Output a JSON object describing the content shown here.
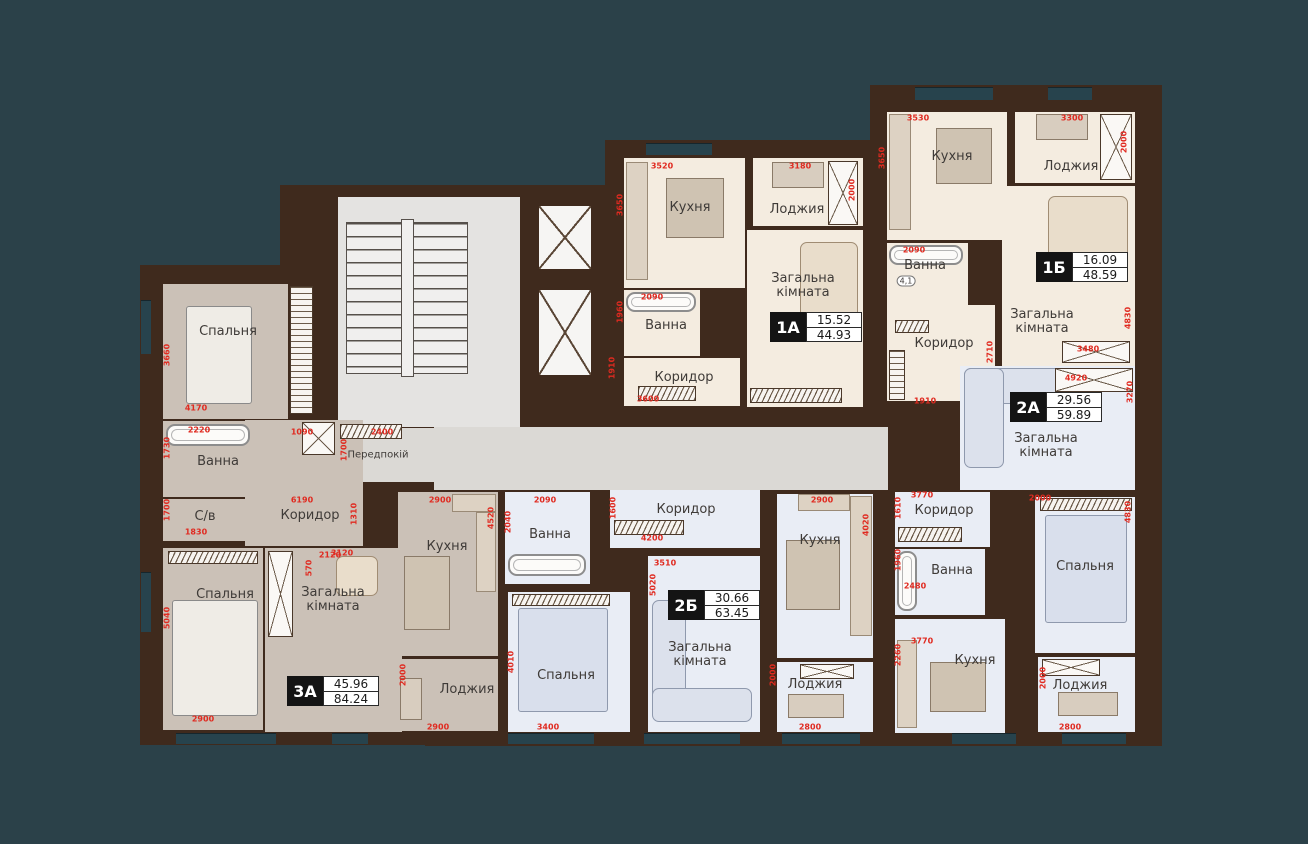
{
  "title": "Floor plan with apartments 1А, 1Б, 2А, 2Б, 3А",
  "colors": {
    "background": "#2b4149",
    "wall": "#3f2a1d",
    "dim_red": "#e02a20",
    "floor_cream": "#f4ece0",
    "floor_blue": "#e9edf5",
    "floor_gray": "#cbc1b7",
    "corridor": "#dbd9d5",
    "badge_black": "#141414"
  },
  "units": [
    {
      "id": "1А",
      "living_area": "15.52",
      "total_area": "44.93"
    },
    {
      "id": "1Б",
      "living_area": "16.09",
      "total_area": "48.59"
    },
    {
      "id": "2А",
      "living_area": "29.56",
      "total_area": "59.89"
    },
    {
      "id": "2Б",
      "living_area": "30.66",
      "total_area": "63.45"
    },
    {
      "id": "3А",
      "living_area": "45.96",
      "total_area": "84.24"
    }
  ],
  "walls": [
    {
      "x": 140,
      "y": 265,
      "w": 200,
      "h": 480
    },
    {
      "x": 280,
      "y": 185,
      "w": 350,
      "h": 560
    },
    {
      "x": 605,
      "y": 140,
      "w": 270,
      "h": 290
    },
    {
      "x": 870,
      "y": 85,
      "w": 292,
      "h": 335
    },
    {
      "x": 870,
      "y": 358,
      "w": 292,
      "h": 388
    },
    {
      "x": 425,
      "y": 420,
      "w": 470,
      "h": 326
    }
  ],
  "floors": [
    {
      "apt": "core",
      "room": "stair-hall",
      "color": "stair",
      "x": 338,
      "y": 197,
      "w": 182,
      "h": 230
    },
    {
      "apt": "core",
      "room": "elevator-1",
      "color": "white",
      "x": 537,
      "y": 204,
      "w": 56,
      "h": 67
    },
    {
      "apt": "core",
      "room": "elevator-2",
      "color": "white",
      "x": 537,
      "y": 288,
      "w": 56,
      "h": 89
    },
    {
      "apt": "core",
      "room": "corridor-common",
      "color": "corr",
      "x": 434,
      "y": 427,
      "w": 454,
      "h": 63
    },
    {
      "apt": "core",
      "room": "entry-hall",
      "label": "Передпокій",
      "lx": 378,
      "ly": 456,
      "small": true,
      "color": "corr",
      "x": 318,
      "y": 428,
      "w": 116,
      "h": 54
    },
    {
      "apt": "3А",
      "room": "bedroom-1",
      "label": "Спальня",
      "lx": 228,
      "ly": 332,
      "color": "gray3",
      "x": 163,
      "y": 284,
      "w": 125,
      "h": 135
    },
    {
      "apt": "3А",
      "room": "bath",
      "label": "Ванна",
      "lx": 218,
      "ly": 462,
      "color": "gray3",
      "x": 163,
      "y": 421,
      "w": 110,
      "h": 76
    },
    {
      "apt": "3А",
      "room": "wc",
      "label": "С/в",
      "lx": 205,
      "ly": 517,
      "color": "gray3",
      "x": 163,
      "y": 499,
      "w": 103,
      "h": 42
    },
    {
      "apt": "3А",
      "room": "corridor",
      "label": "Коридор",
      "lx": 310,
      "ly": 516,
      "color": "gray3",
      "x": 245,
      "y": 420,
      "w": 118,
      "h": 126
    },
    {
      "apt": "3А",
      "room": "bedroom-2",
      "label": "Спальня",
      "lx": 225,
      "ly": 595,
      "color": "gray3",
      "x": 163,
      "y": 548,
      "w": 100,
      "h": 182
    },
    {
      "apt": "3А",
      "room": "living",
      "label": "Загальна кімната",
      "wrap": true,
      "lx": 333,
      "ly": 600,
      "color": "gray3",
      "x": 265,
      "y": 548,
      "w": 137,
      "h": 184
    },
    {
      "apt": "3А",
      "room": "kitchen",
      "label": "Кухня",
      "lx": 447,
      "ly": 547,
      "color": "gray3",
      "x": 398,
      "y": 492,
      "w": 100,
      "h": 164
    },
    {
      "apt": "3А",
      "room": "loggia",
      "label": "Лоджия",
      "lx": 467,
      "ly": 690,
      "color": "gray3",
      "x": 398,
      "y": 659,
      "w": 100,
      "h": 72
    },
    {
      "apt": "1А",
      "room": "kitchen",
      "label": "Кухня",
      "lx": 690,
      "ly": 208,
      "color": "cream",
      "x": 624,
      "y": 158,
      "w": 121,
      "h": 130
    },
    {
      "apt": "1А",
      "room": "loggia",
      "label": "Лоджия",
      "lx": 797,
      "ly": 210,
      "color": "cream",
      "x": 753,
      "y": 158,
      "w": 110,
      "h": 68
    },
    {
      "apt": "1А",
      "room": "living",
      "label": "Загальна кімната",
      "wrap": true,
      "lx": 803,
      "ly": 286,
      "color": "cream",
      "x": 747,
      "y": 230,
      "w": 116,
      "h": 177
    },
    {
      "apt": "1А",
      "room": "bath",
      "label": "Ванна",
      "lx": 666,
      "ly": 326,
      "color": "cream",
      "x": 624,
      "y": 290,
      "w": 76,
      "h": 66
    },
    {
      "apt": "1А",
      "room": "corridor",
      "label": "Коридор",
      "lx": 684,
      "ly": 378,
      "color": "cream",
      "x": 624,
      "y": 358,
      "w": 116,
      "h": 48
    },
    {
      "apt": "1Б",
      "room": "kitchen",
      "label": "Кухня",
      "lx": 952,
      "ly": 157,
      "color": "cream",
      "x": 887,
      "y": 112,
      "w": 120,
      "h": 128
    },
    {
      "apt": "1Б",
      "room": "loggia",
      "label": "Лоджия",
      "lx": 1071,
      "ly": 167,
      "color": "cream",
      "x": 1015,
      "y": 112,
      "w": 120,
      "h": 71
    },
    {
      "apt": "1Б",
      "room": "living",
      "label": "Загальна кімната",
      "wrap": true,
      "lx": 1042,
      "ly": 322,
      "color": "cream",
      "x": 1002,
      "y": 186,
      "w": 133,
      "h": 183
    },
    {
      "apt": "1Б",
      "room": "bath",
      "label": "Ванна",
      "lx": 925,
      "ly": 266,
      "color": "cream",
      "x": 887,
      "y": 243,
      "w": 81,
      "h": 62
    },
    {
      "apt": "1Б",
      "room": "corridor",
      "label": "Коридор",
      "lx": 944,
      "ly": 344,
      "color": "cream",
      "x": 887,
      "y": 305,
      "w": 108,
      "h": 96
    },
    {
      "apt": "2А",
      "room": "living",
      "label": "Загальна кімната",
      "wrap": true,
      "lx": 1046,
      "ly": 446,
      "color": "blue",
      "x": 960,
      "y": 366,
      "w": 175,
      "h": 124
    },
    {
      "apt": "2А",
      "room": "corridor",
      "label": "Коридор",
      "lx": 944,
      "ly": 511,
      "color": "blue",
      "x": 895,
      "y": 492,
      "w": 95,
      "h": 55
    },
    {
      "apt": "2А",
      "room": "bath",
      "label": "Ванна",
      "lx": 952,
      "ly": 571,
      "color": "blue",
      "x": 895,
      "y": 549,
      "w": 90,
      "h": 66
    },
    {
      "apt": "2А",
      "room": "kitchen",
      "label": "Кухня",
      "lx": 975,
      "ly": 661,
      "color": "blue",
      "x": 895,
      "y": 619,
      "w": 110,
      "h": 114
    },
    {
      "apt": "2А",
      "room": "bedroom",
      "label": "Спальня",
      "lx": 1085,
      "ly": 567,
      "color": "blue",
      "x": 1035,
      "y": 497,
      "w": 100,
      "h": 156
    },
    {
      "apt": "2А",
      "room": "loggia",
      "label": "Лоджия",
      "lx": 1080,
      "ly": 686,
      "color": "blue",
      "x": 1038,
      "y": 657,
      "w": 97,
      "h": 75
    },
    {
      "apt": "2Б",
      "room": "corridor",
      "label": "Коридор",
      "lx": 686,
      "ly": 510,
      "color": "blue",
      "x": 610,
      "y": 490,
      "w": 150,
      "h": 58
    },
    {
      "apt": "2Б",
      "room": "bath",
      "label": "Ванна",
      "lx": 550,
      "ly": 535,
      "color": "blue",
      "x": 505,
      "y": 492,
      "w": 85,
      "h": 92
    },
    {
      "apt": "2Б",
      "room": "bedroom",
      "label": "Спальня",
      "lx": 566,
      "ly": 676,
      "color": "blue",
      "x": 508,
      "y": 592,
      "w": 122,
      "h": 140
    },
    {
      "apt": "2Б",
      "room": "living",
      "label": "Загальна кімната",
      "wrap": true,
      "lx": 700,
      "ly": 655,
      "color": "blue",
      "x": 648,
      "y": 556,
      "w": 112,
      "h": 176
    },
    {
      "apt": "2Б",
      "room": "kitchen",
      "label": "Кухня",
      "lx": 820,
      "ly": 541,
      "color": "blue",
      "x": 777,
      "y": 494,
      "w": 96,
      "h": 164
    },
    {
      "apt": "2Б",
      "room": "loggia",
      "label": "Лоджия",
      "lx": 815,
      "ly": 685,
      "color": "blue",
      "x": 777,
      "y": 662,
      "w": 96,
      "h": 70
    }
  ],
  "badges": [
    {
      "unit": "1А",
      "top": "15.52",
      "bottom": "44.93",
      "x": 770,
      "y": 312
    },
    {
      "unit": "1Б",
      "top": "16.09",
      "bottom": "48.59",
      "x": 1036,
      "y": 252
    },
    {
      "unit": "2А",
      "top": "29.56",
      "bottom": "59.89",
      "x": 1010,
      "y": 392
    },
    {
      "unit": "2Б",
      "top": "30.66",
      "bottom": "63.45",
      "x": 668,
      "y": 590
    },
    {
      "unit": "3А",
      "top": "45.96",
      "bottom": "84.24",
      "x": 287,
      "y": 676
    }
  ],
  "dims": [
    {
      "t": "3520",
      "x": 662,
      "y": 166
    },
    {
      "t": "3650",
      "x": 620,
      "y": 205,
      "v": true
    },
    {
      "t": "3180",
      "x": 800,
      "y": 166
    },
    {
      "t": "2000",
      "x": 852,
      "y": 190,
      "v": true
    },
    {
      "t": "2090",
      "x": 652,
      "y": 297
    },
    {
      "t": "1960",
      "x": 620,
      "y": 312,
      "v": true
    },
    {
      "t": "1910",
      "x": 612,
      "y": 368,
      "v": true
    },
    {
      "t": "3600",
      "x": 648,
      "y": 399
    },
    {
      "t": "3530",
      "x": 918,
      "y": 118
    },
    {
      "t": "3650",
      "x": 882,
      "y": 158,
      "v": true
    },
    {
      "t": "3300",
      "x": 1072,
      "y": 118
    },
    {
      "t": "2000",
      "x": 1124,
      "y": 142,
      "v": true
    },
    {
      "t": "2090",
      "x": 914,
      "y": 250
    },
    {
      "t": "1910",
      "x": 925,
      "y": 401
    },
    {
      "t": "2710",
      "x": 990,
      "y": 352,
      "v": true
    },
    {
      "t": "4830",
      "x": 1128,
      "y": 318,
      "v": true
    },
    {
      "t": "3480",
      "x": 1088,
      "y": 349
    },
    {
      "t": "4920",
      "x": 1076,
      "y": 378
    },
    {
      "t": "3270",
      "x": 1130,
      "y": 392,
      "v": true
    },
    {
      "t": "2000",
      "x": 1040,
      "y": 498
    },
    {
      "t": "4830",
      "x": 1128,
      "y": 512,
      "v": true
    },
    {
      "t": "3770",
      "x": 922,
      "y": 495
    },
    {
      "t": "1610",
      "x": 898,
      "y": 508,
      "v": true
    },
    {
      "t": "2480",
      "x": 915,
      "y": 586
    },
    {
      "t": "1960",
      "x": 898,
      "y": 560,
      "v": true
    },
    {
      "t": "3770",
      "x": 922,
      "y": 641
    },
    {
      "t": "2260",
      "x": 898,
      "y": 655,
      "v": true
    },
    {
      "t": "2000",
      "x": 1043,
      "y": 678,
      "v": true
    },
    {
      "t": "2800",
      "x": 1070,
      "y": 727
    },
    {
      "t": "1600",
      "x": 613,
      "y": 508,
      "v": true
    },
    {
      "t": "4200",
      "x": 652,
      "y": 538
    },
    {
      "t": "3510",
      "x": 665,
      "y": 563
    },
    {
      "t": "5020",
      "x": 653,
      "y": 585,
      "v": true
    },
    {
      "t": "2900",
      "x": 822,
      "y": 500
    },
    {
      "t": "4020",
      "x": 866,
      "y": 525,
      "v": true
    },
    {
      "t": "2090",
      "x": 545,
      "y": 500
    },
    {
      "t": "2040",
      "x": 508,
      "y": 522,
      "v": true
    },
    {
      "t": "4010",
      "x": 511,
      "y": 662,
      "v": true
    },
    {
      "t": "3400",
      "x": 548,
      "y": 727
    },
    {
      "t": "2000",
      "x": 773,
      "y": 675,
      "v": true
    },
    {
      "t": "2800",
      "x": 810,
      "y": 727
    },
    {
      "t": "3660",
      "x": 167,
      "y": 355,
      "v": true
    },
    {
      "t": "4170",
      "x": 196,
      "y": 408
    },
    {
      "t": "2220",
      "x": 199,
      "y": 430
    },
    {
      "t": "1730",
      "x": 167,
      "y": 448,
      "v": true
    },
    {
      "t": "1830",
      "x": 196,
      "y": 532
    },
    {
      "t": "1700",
      "x": 167,
      "y": 510,
      "v": true
    },
    {
      "t": "1090",
      "x": 302,
      "y": 432
    },
    {
      "t": "1700",
      "x": 344,
      "y": 450,
      "v": true
    },
    {
      "t": "2400",
      "x": 382,
      "y": 432
    },
    {
      "t": "6190",
      "x": 302,
      "y": 500
    },
    {
      "t": "1310",
      "x": 354,
      "y": 514,
      "v": true
    },
    {
      "t": "2120",
      "x": 330,
      "y": 555
    },
    {
      "t": "5040",
      "x": 167,
      "y": 618,
      "v": true
    },
    {
      "t": "2900",
      "x": 203,
      "y": 719
    },
    {
      "t": "3120",
      "x": 342,
      "y": 553
    },
    {
      "t": "570",
      "x": 309,
      "y": 568,
      "v": true
    },
    {
      "t": "2900",
      "x": 440,
      "y": 500
    },
    {
      "t": "4520",
      "x": 491,
      "y": 518,
      "v": true
    },
    {
      "t": "2000",
      "x": 403,
      "y": 675,
      "v": true
    },
    {
      "t": "2900",
      "x": 438,
      "y": 727
    }
  ],
  "notes": [
    {
      "t": "4,1",
      "x": 906,
      "y": 281
    }
  ],
  "fixtures": [
    {
      "type": "stairs",
      "x": 346,
      "y": 222,
      "w": 122,
      "h": 152
    },
    {
      "type": "elev",
      "x": 537,
      "y": 204,
      "w": 56,
      "h": 67
    },
    {
      "type": "elev",
      "x": 537,
      "y": 288,
      "w": 56,
      "h": 89
    },
    {
      "type": "xbox",
      "x": 302,
      "y": 422,
      "w": 33,
      "h": 33
    },
    {
      "type": "hatch",
      "x": 340,
      "y": 424,
      "w": 62,
      "h": 15
    },
    {
      "type": "hatchv",
      "x": 290,
      "y": 286,
      "w": 23,
      "h": 128
    },
    {
      "type": "hatch",
      "x": 168,
      "y": 551,
      "w": 90,
      "h": 13
    },
    {
      "type": "xbox",
      "x": 268,
      "y": 551,
      "w": 25,
      "h": 86
    },
    {
      "type": "tub",
      "x": 166,
      "y": 424,
      "w": 84,
      "h": 22
    },
    {
      "type": "bed",
      "x": 186,
      "y": 306,
      "w": 66,
      "h": 98
    },
    {
      "type": "bed",
      "x": 172,
      "y": 600,
      "w": 86,
      "h": 116
    },
    {
      "type": "sofa tan",
      "x": 336,
      "y": 556,
      "w": 42,
      "h": 40
    },
    {
      "type": "table",
      "x": 404,
      "y": 556,
      "w": 46,
      "h": 74
    },
    {
      "type": "counter",
      "x": 452,
      "y": 494,
      "w": 44,
      "h": 18
    },
    {
      "type": "counter",
      "x": 476,
      "y": 512,
      "w": 20,
      "h": 80
    },
    {
      "type": "desk",
      "x": 400,
      "y": 678,
      "w": 22,
      "h": 42
    },
    {
      "type": "counter",
      "x": 626,
      "y": 162,
      "w": 22,
      "h": 118
    },
    {
      "type": "table",
      "x": 666,
      "y": 178,
      "w": 58,
      "h": 60
    },
    {
      "type": "xbox",
      "x": 828,
      "y": 161,
      "w": 30,
      "h": 64
    },
    {
      "type": "desk",
      "x": 772,
      "y": 162,
      "w": 52,
      "h": 26
    },
    {
      "type": "sofa tan",
      "x": 800,
      "y": 242,
      "w": 58,
      "h": 86
    },
    {
      "type": "tub",
      "x": 626,
      "y": 292,
      "w": 70,
      "h": 20
    },
    {
      "type": "hatch",
      "x": 638,
      "y": 386,
      "w": 58,
      "h": 15
    },
    {
      "type": "hatch",
      "x": 750,
      "y": 388,
      "w": 92,
      "h": 15
    },
    {
      "type": "counter",
      "x": 889,
      "y": 114,
      "w": 22,
      "h": 116
    },
    {
      "type": "table",
      "x": 936,
      "y": 128,
      "w": 56,
      "h": 56
    },
    {
      "type": "xbox",
      "x": 1100,
      "y": 114,
      "w": 32,
      "h": 66
    },
    {
      "type": "desk",
      "x": 1036,
      "y": 114,
      "w": 52,
      "h": 26
    },
    {
      "type": "sofa tan",
      "x": 1048,
      "y": 196,
      "w": 80,
      "h": 78
    },
    {
      "type": "tub",
      "x": 889,
      "y": 245,
      "w": 74,
      "h": 20
    },
    {
      "type": "hatch",
      "x": 895,
      "y": 320,
      "w": 34,
      "h": 13
    },
    {
      "type": "hatchv",
      "x": 889,
      "y": 350,
      "w": 16,
      "h": 50
    },
    {
      "type": "xbox",
      "x": 1062,
      "y": 341,
      "w": 68,
      "h": 22
    },
    {
      "type": "sofa",
      "x": 964,
      "y": 368,
      "w": 118,
      "h": 36
    },
    {
      "type": "sofa",
      "x": 964,
      "y": 368,
      "w": 40,
      "h": 100
    },
    {
      "type": "xbox",
      "x": 1055,
      "y": 368,
      "w": 78,
      "h": 24
    },
    {
      "type": "hatch",
      "x": 898,
      "y": 527,
      "w": 64,
      "h": 15
    },
    {
      "type": "tub",
      "x": 897,
      "y": 551,
      "w": 20,
      "h": 60
    },
    {
      "type": "table",
      "x": 930,
      "y": 662,
      "w": 56,
      "h": 50
    },
    {
      "type": "counter",
      "x": 897,
      "y": 640,
      "w": 20,
      "h": 88
    },
    {
      "type": "bed blue",
      "x": 1045,
      "y": 515,
      "w": 82,
      "h": 108
    },
    {
      "type": "hatch",
      "x": 1040,
      "y": 498,
      "w": 92,
      "h": 13
    },
    {
      "type": "xbox",
      "x": 1042,
      "y": 659,
      "w": 58,
      "h": 17
    },
    {
      "type": "desk",
      "x": 1058,
      "y": 692,
      "w": 60,
      "h": 24
    },
    {
      "type": "hatch",
      "x": 614,
      "y": 520,
      "w": 70,
      "h": 15
    },
    {
      "type": "tub",
      "x": 508,
      "y": 554,
      "w": 78,
      "h": 22
    },
    {
      "type": "hatch",
      "x": 512,
      "y": 594,
      "w": 98,
      "h": 12
    },
    {
      "type": "bed blue",
      "x": 518,
      "y": 608,
      "w": 90,
      "h": 104
    },
    {
      "type": "sofa",
      "x": 652,
      "y": 600,
      "w": 34,
      "h": 120
    },
    {
      "type": "sofa",
      "x": 652,
      "y": 688,
      "w": 100,
      "h": 34
    },
    {
      "type": "table",
      "x": 786,
      "y": 540,
      "w": 54,
      "h": 70
    },
    {
      "type": "counter",
      "x": 850,
      "y": 496,
      "w": 22,
      "h": 140
    },
    {
      "type": "counter",
      "x": 798,
      "y": 494,
      "w": 52,
      "h": 17
    },
    {
      "type": "xbox",
      "x": 800,
      "y": 664,
      "w": 54,
      "h": 15
    },
    {
      "type": "desk",
      "x": 788,
      "y": 694,
      "w": 56,
      "h": 24
    }
  ],
  "windows": [
    {
      "x": 646,
      "y": 143,
      "w": 66,
      "h": 12
    },
    {
      "x": 915,
      "y": 87,
      "w": 78,
      "h": 13
    },
    {
      "x": 1048,
      "y": 87,
      "w": 44,
      "h": 13
    },
    {
      "x": 176,
      "y": 733,
      "w": 100,
      "h": 11
    },
    {
      "x": 332,
      "y": 733,
      "w": 36,
      "h": 11
    },
    {
      "x": 508,
      "y": 733,
      "w": 86,
      "h": 11
    },
    {
      "x": 644,
      "y": 733,
      "w": 96,
      "h": 11
    },
    {
      "x": 782,
      "y": 733,
      "w": 78,
      "h": 11
    },
    {
      "x": 952,
      "y": 733,
      "w": 64,
      "h": 11
    },
    {
      "x": 1062,
      "y": 733,
      "w": 64,
      "h": 11
    },
    {
      "x": 141,
      "y": 300,
      "w": 10,
      "h": 54
    },
    {
      "x": 141,
      "y": 572,
      "w": 10,
      "h": 60
    }
  ]
}
